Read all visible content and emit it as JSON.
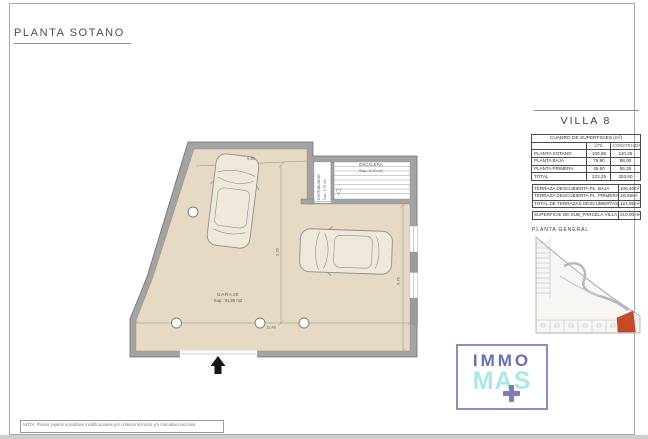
{
  "sheet": {
    "title": "PLANTA SOTANO",
    "note": "NOTA: Planos sujetos a posibles modificaciones por criterios técnicos y/o normativa sectorial"
  },
  "plan": {
    "garage": {
      "name": "GARAJE",
      "area": "Sup.: 91,95  m2"
    },
    "stairs": {
      "name": "ESCALERA",
      "area": "Sup.: 6,20  m2"
    },
    "hall": {
      "name": "DISTRIBUIDOR",
      "area": "Sup.: 2,70  m2"
    },
    "dimensions": {
      "top_width": "5,90",
      "inner_height": "9,29",
      "bottom_width": "12,40",
      "right_height": "6,76"
    }
  },
  "panel": {
    "villa_title": "VILLA 8",
    "surfaces_table": {
      "title": "CUADRO DE SUPERFICIES (m²)",
      "columns": {
        "util": "ÚTIL",
        "construida": "CONSTRUIDA"
      },
      "rows": [
        {
          "label": "PLANTA SOTANO",
          "util": "100,85",
          "construida": "110,25"
        },
        {
          "label": "PLANTA BAJA",
          "util": "76,90",
          "construida": "88,00"
        },
        {
          "label": "PLANTA PRIMERA",
          "util": "45,50",
          "construida": "55,35"
        },
        {
          "label": "TOTAL",
          "util": "223,25",
          "construida": "253,60"
        }
      ]
    },
    "terraces_table": {
      "rows": [
        {
          "label": "TERRAZA DESCUBIERTA PL. BAJA",
          "value": "106,40m²"
        },
        {
          "label": "TERRAZA DESCUBIERTA PL. PRIMERA",
          "value": "18,55m²"
        },
        {
          "label": "TOTAL DE TERRAZAS DESCUBIERTAS",
          "value": "124,95m²"
        }
      ]
    },
    "parcel_row": {
      "label": "SUPERFICIE DE SUB_PARCELA VILLA 8",
      "value": "219,00 m²"
    },
    "site_plan_title": "PLANTA GENERAL"
  },
  "logo": {
    "top": "IMMO",
    "bottom": "MAS"
  },
  "colors": {
    "floor": "#e6dac4",
    "wall": "#a3a3a3",
    "highlight_plot": "#c74b2b",
    "logo_purple": "#6c6cb4",
    "logo_cyan": "#abe6ea"
  }
}
